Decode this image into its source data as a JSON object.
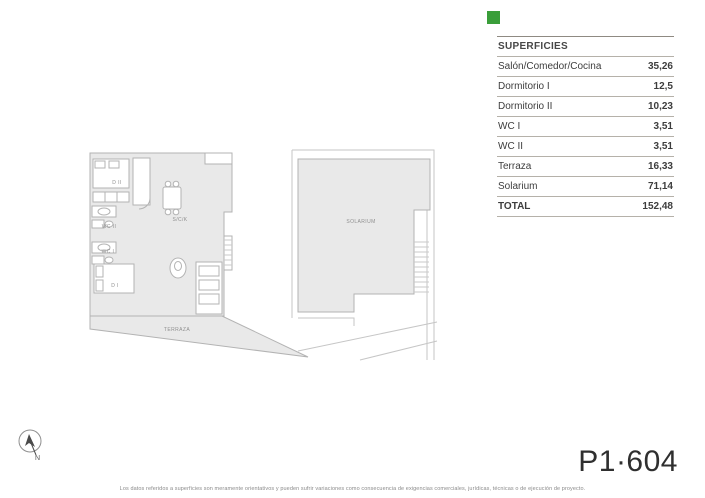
{
  "brand": {
    "square_color": "#3a9e3a"
  },
  "surfaces_table": {
    "header": "SUPERFICIES",
    "rows": [
      {
        "label": "Salón/Comedor/Cocina",
        "value": "35,26"
      },
      {
        "label": "Dormitorio I",
        "value": "12,5"
      },
      {
        "label": "Dormitorio II",
        "value": "10,23"
      },
      {
        "label": "WC I",
        "value": "3,51"
      },
      {
        "label": "WC II",
        "value": "3,51"
      },
      {
        "label": "Terraza",
        "value": "16,33"
      },
      {
        "label": "Solarium",
        "value": "71,14"
      }
    ],
    "total": {
      "label": "TOTAL",
      "value": "152,48"
    }
  },
  "floor_plan": {
    "rooms": {
      "dormitorio2": "D II",
      "wc2": "WC II",
      "wc1": "WC I",
      "dormitorio1": "D I",
      "salon_comedor_cocina": "S/C/K",
      "terraza": "TERRAZA",
      "solarium": "SOLARIUM"
    }
  },
  "unit_code": "P1·604",
  "compass": {
    "letter": "N"
  },
  "footer": {
    "disclaimer": "Los datos referidos a superficies son meramente orientativos y pueden sufrir variaciones como consecuencia de exigencias comerciales, jurídicas, técnicas o de ejecución de proyecto."
  },
  "colors": {
    "plan_fill": "#e9e9e9",
    "plan_stroke": "#b3b3b3",
    "table_text": "#3d3d3d",
    "table_border": "#b5b1a9",
    "unit_code_text": "#2f2f2f"
  }
}
